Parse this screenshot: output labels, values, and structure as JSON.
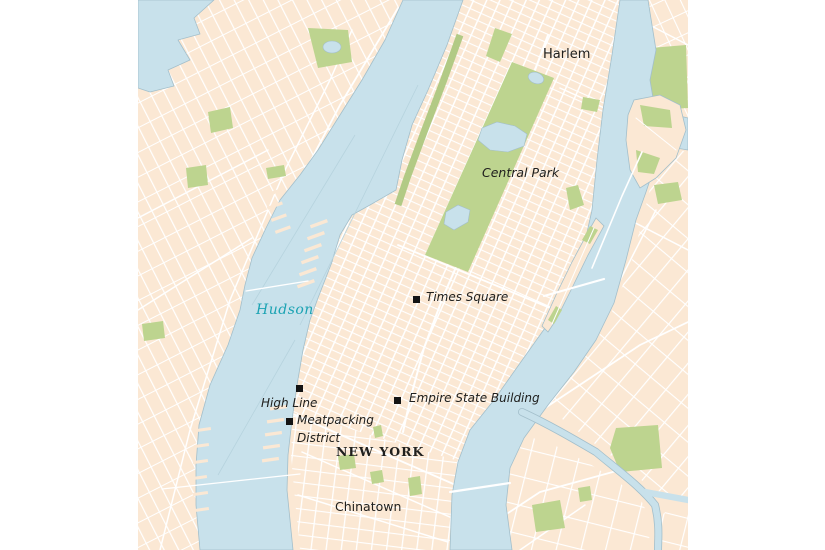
{
  "map": {
    "labels": {
      "harlem": "Harlem",
      "central_park": "Central Park",
      "times_square": "Times Square",
      "hudson": "Hudson",
      "high_line": "High Line",
      "meatpacking_line1": "Meatpacking",
      "meatpacking_line2": "District",
      "empire_state": "Empire State Building",
      "new_york": "NEW YORK",
      "chinatown": "Chinatown"
    },
    "colors": {
      "land": "#fbe8d4",
      "water": "#c8e1eb",
      "coast": "#a3bfcb",
      "park": "#bdd48f",
      "road": "#ffffff",
      "label": "#20201e",
      "water_label": "#1ba3b3",
      "marker": "#141414"
    }
  }
}
